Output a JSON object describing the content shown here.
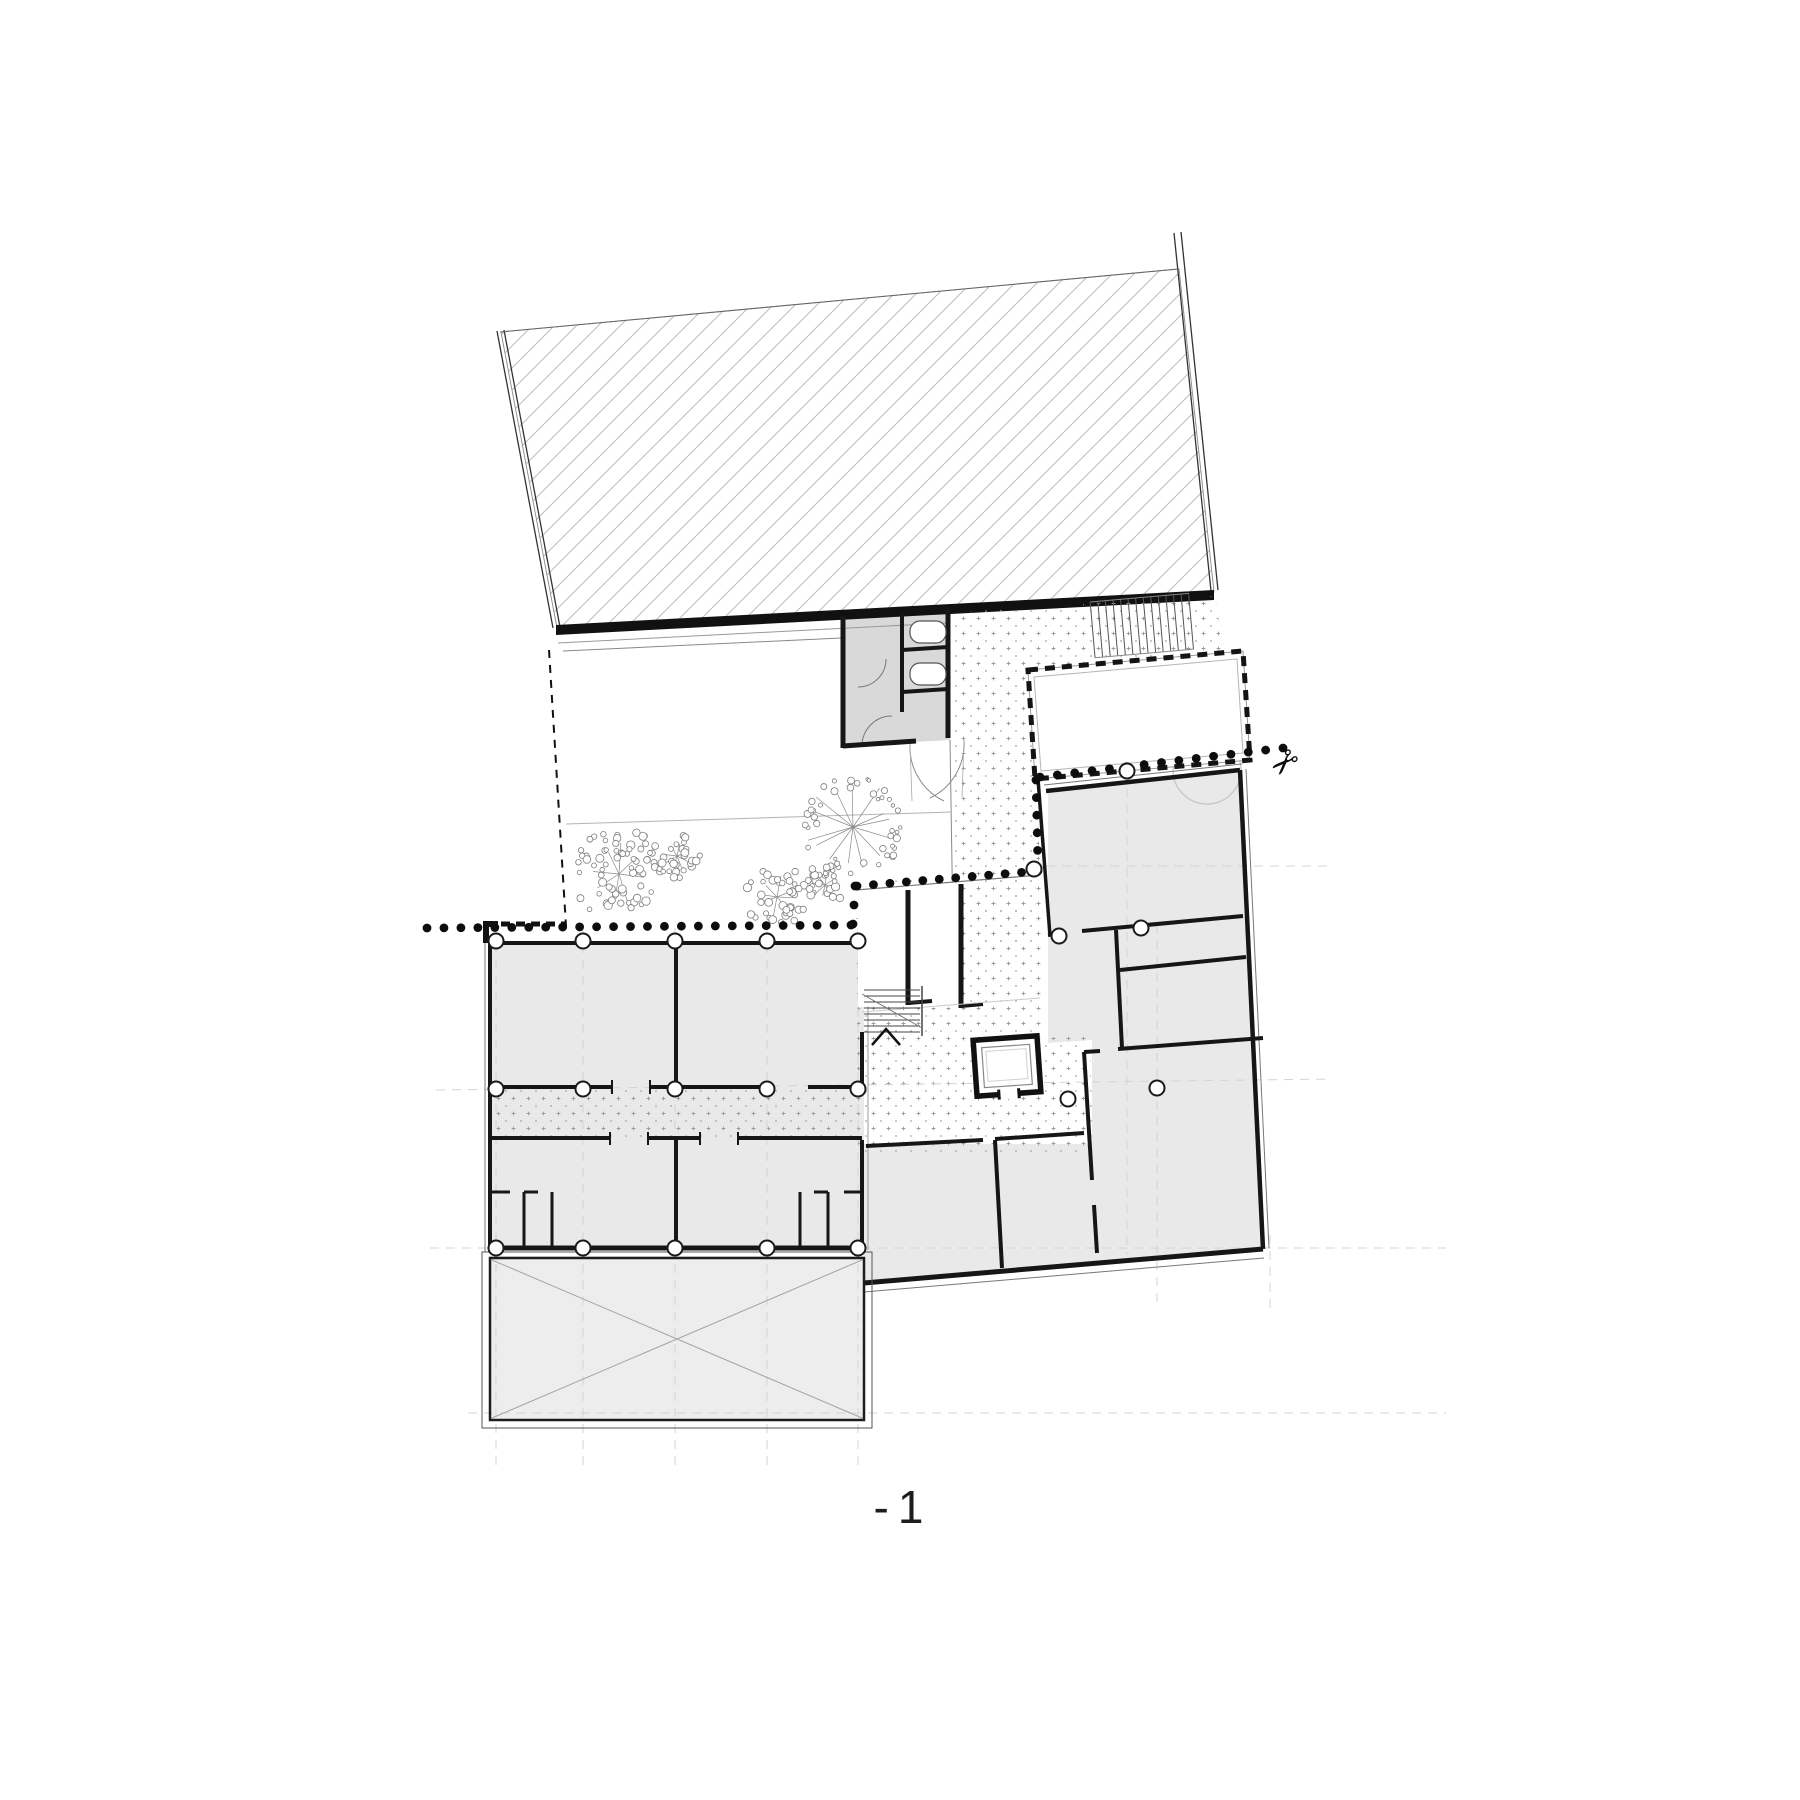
{
  "plan": {
    "floor_label": "-1",
    "drawing_type": "basement-floor-plan"
  },
  "icons": {
    "scissors_glyph": "✂"
  },
  "colors": {
    "background": "#ffffff",
    "wall": "#161616",
    "wall_soft": "#555555",
    "room_fill": "#e9e9e9",
    "service_fill": "#d9d9d9",
    "hatch_line": "#bcbcbc",
    "stipple": "#9a9a9a",
    "grid_dash": "#d4d4d4",
    "tree_stroke": "#8a8a8a",
    "x_line": "#a3a3a3",
    "label_ink": "#1c1c1c"
  }
}
